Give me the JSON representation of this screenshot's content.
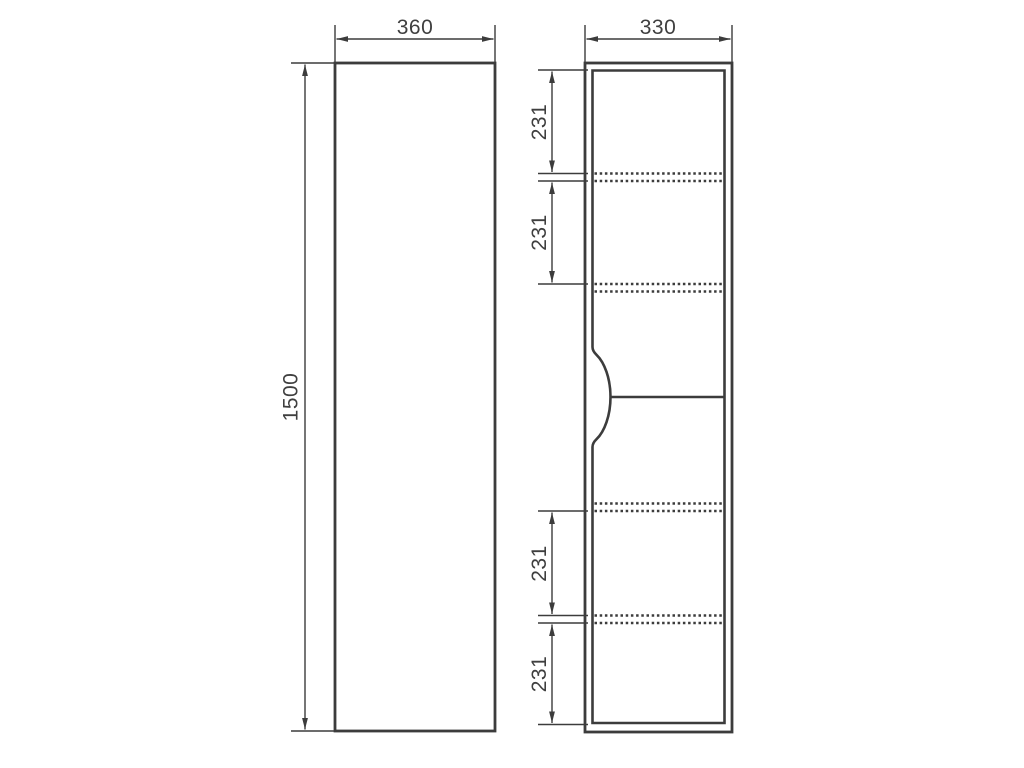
{
  "drawing": {
    "type": "cabinet-dimension-drawing",
    "colors": {
      "line": "#3c3c3c",
      "text": "#3f3f3f",
      "background": "#ffffff"
    },
    "front_view": {
      "width_mm": "360",
      "height_mm": "1500"
    },
    "side_view": {
      "depth_mm": "330",
      "shelf_spacings_mm": [
        "231",
        "231",
        "231",
        "231"
      ]
    }
  }
}
